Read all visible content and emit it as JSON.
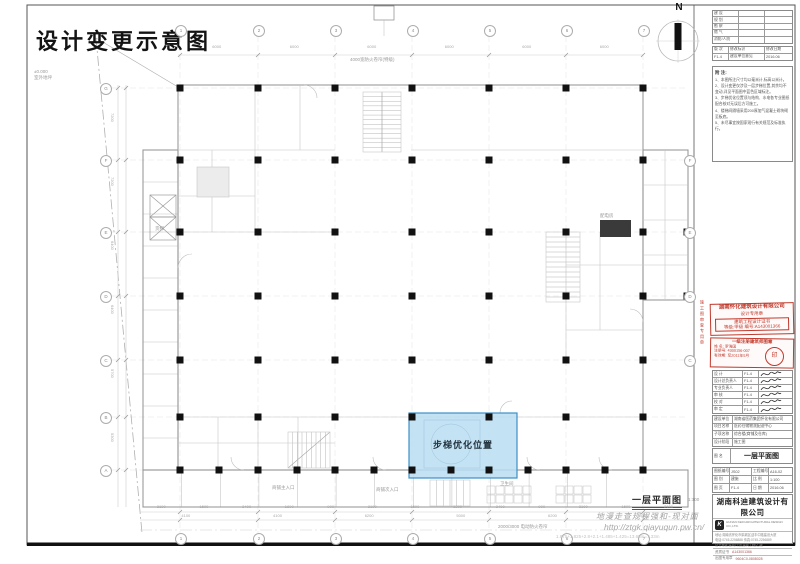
{
  "sheet": {
    "title": "设计变更示意图",
    "north_label": "N"
  },
  "colors": {
    "highlight_fill": "#b9ddf1",
    "highlight_border": "#3e8fc7",
    "stamp_red": "#c0392b"
  },
  "plan": {
    "highlight_label": "步梯优化位置",
    "drawing_title": "一层平面图",
    "drawing_scale": "1:100",
    "watermark": {
      "line1": "地漫走查规程强和-现对面",
      "line2": "http://ztgk.qiayuqun.pw.cn/",
      "line3": "1.875+1.825+2.8+2.1+1.485+1.425=13.65m=7.33m"
    },
    "grid_labels_top": [
      "1",
      "2",
      "3",
      "4",
      "5",
      "6",
      "7"
    ],
    "grid_labels_bottom": [
      "1",
      "2",
      "3",
      "4",
      "5",
      "6",
      "7"
    ],
    "grid_labels_left": [
      "G",
      "F",
      "E",
      "D",
      "C",
      "B",
      "A"
    ],
    "grid_labels_right": [
      "F",
      "E",
      "D",
      "C"
    ],
    "dims_top": [
      "6000",
      "6000",
      "6000",
      "6000",
      "6000",
      "6000"
    ],
    "dims_bottom_row1": [
      "2100",
      "1500",
      "3400",
      "1800",
      "900",
      "2100",
      "1500",
      "1300",
      "3400",
      "900",
      "2100",
      "1500",
      "2100"
    ],
    "dims_bottom_row2": [
      "4100",
      "4100",
      "6200",
      "5000",
      "6200",
      "4100"
    ],
    "dims_left": [
      "7200",
      "7200",
      "6400",
      "6400",
      "5700",
      "5300"
    ],
    "annotations": [
      {
        "text": "±0.000",
        "x": 34,
        "y": 69
      },
      {
        "text": "室外地坪",
        "x": 34,
        "y": 75
      },
      {
        "text": "4000宽防火卷帘(特级)",
        "x": 350,
        "y": 57
      },
      {
        "text": "商铺主入口",
        "x": 272,
        "y": 485
      },
      {
        "text": "商铺次入口",
        "x": 376,
        "y": 487
      },
      {
        "text": "卫生间",
        "x": 500,
        "y": 481
      },
      {
        "text": "货梯",
        "x": 155,
        "y": 226
      },
      {
        "text": "配电房",
        "x": 600,
        "y": 213
      },
      {
        "text": "2000/3000 电动防火卷帘",
        "x": 498,
        "y": 524
      }
    ]
  },
  "titleblock": {
    "approvals": [
      "建  设",
      "规  划",
      "勘  察",
      "燃  气",
      "消防/人防"
    ],
    "revision_header": [
      "版 次",
      "修改标识",
      "修改日期"
    ],
    "revision_row": [
      "F1-4",
      "建设单位意见",
      "2016.06"
    ],
    "notes_title": "附 注:",
    "notes": [
      "1、本图所注尺寸均以毫米计,标高以米计。",
      "2、设计变更仅涉及一层步梯位置,其余均不变动,详见平面图中蓝色区域标注。",
      "3、步梯优化位置须与结构、水电各专业图纸配合核对无误后方可施工。",
      "4、楼梯间隔墙采用200厚加气混凝土砌块砌至板底。",
      "5、未尽事宜按国家现行有关规范及标准执行。"
    ],
    "stamp1": [
      "湖南怀化建筑设计有限公司",
      "设计专用章",
      "建筑工程设计证书",
      "等级:甲级  编号:A143001366"
    ],
    "stamp2": {
      "line1": "一级注册建筑师图章",
      "rows": [
        [
          "姓  名",
          "罗海国"
        ],
        [
          "注册号",
          "4300156-007"
        ],
        [
          "有效期",
          "至2011年5月"
        ]
      ],
      "seal": "印"
    },
    "signatures": [
      {
        "role": "设  计",
        "doc": "F1-4"
      },
      {
        "role": "设计总负责人",
        "doc": "F1-4"
      },
      {
        "role": "专业负责人",
        "doc": "F1-4"
      },
      {
        "role": "审  核",
        "doc": "F1-4"
      },
      {
        "role": "校  对",
        "doc": "F1-4"
      },
      {
        "role": "审  定",
        "doc": "F1-4"
      }
    ],
    "project_rows": [
      [
        "建设单位",
        "湖南省医药集团怀化有限公司"
      ],
      [
        "项目名称",
        "医药仓储物流配送中心"
      ],
      [
        "子项名称",
        "综合楼(商铺及仓库)"
      ],
      [
        "设计阶段",
        "施工图"
      ]
    ],
    "sheet_name_label": "图  名",
    "sheet_name": "一层平面图",
    "numbers": [
      [
        "图纸编号",
        "JS02"
      ],
      [
        "工程编号",
        "A16-02"
      ],
      [
        "图  别",
        "建施"
      ],
      [
        "比  例",
        "1:100"
      ],
      [
        "图  页",
        "F1-4"
      ],
      [
        "日  期",
        "2016.06"
      ]
    ],
    "company": {
      "name": "湖南科迪建筑设计有限公司",
      "en": "HUNAN KEDI ARCHITECTURAL DESIGN CO.,LTD.",
      "logo_glyph": "K",
      "info": [
        "地址:湖南省怀化市鹤城区迎丰中路建设大厦",
        "电话:0745-2256888  传真:0745-2256889",
        "证书等级:建筑行业(建筑工程)乙级"
      ],
      "bottom_rows": [
        [
          "资质证书",
          "A143001366"
        ],
        [
          "出图专用章",
          "9604C0-0808028"
        ]
      ]
    },
    "vertical_stamp_text": "施工图审查专用章"
  }
}
